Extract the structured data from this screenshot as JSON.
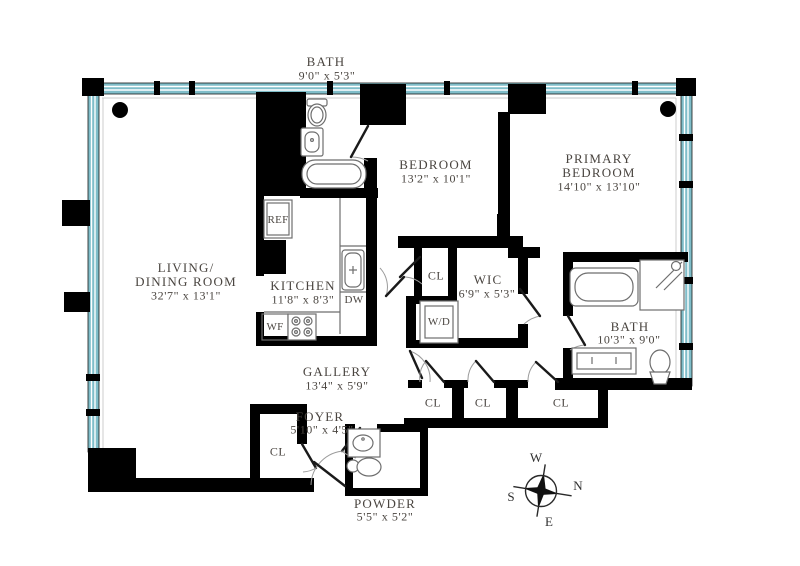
{
  "plan": {
    "rooms": {
      "bath_top": {
        "name": "BATH",
        "dims": "9'0\" x 5'3\""
      },
      "bedroom": {
        "name": "BEDROOM",
        "dims": "13'2\" x 10'1\""
      },
      "primary_bedroom": {
        "name_line1": "PRIMARY",
        "name_line2": "BEDROOM",
        "dims": "14'10\" x 13'10\""
      },
      "living_dining": {
        "name_line1": "LIVING/",
        "name_line2": "DINING ROOM",
        "dims": "32'7\" x 13'1\""
      },
      "kitchen": {
        "name": "KITCHEN",
        "dims": "11'8\" x 8'3\""
      },
      "wic": {
        "name": "WIC",
        "dims": "6'9\" x 5'3\""
      },
      "primary_bath": {
        "name": "BATH",
        "dims": "10'3\" x 9'0\""
      },
      "gallery": {
        "name": "GALLERY",
        "dims": "13'4\" x 5'9\""
      },
      "foyer": {
        "name": "FOYER",
        "dims": "5'10\" x 4'5\""
      },
      "powder": {
        "name": "POWDER",
        "dims": "5'5\" x 5'2\""
      }
    },
    "closets": {
      "hall": "CL",
      "row_1": "CL",
      "row_2": "CL",
      "row_3": "CL",
      "foyer": "CL"
    },
    "appliances": {
      "refrigerator": "REF",
      "dishwasher": "DW",
      "wine_fridge": "WF",
      "washer_dryer": "W/D"
    },
    "compass": {
      "north": "N",
      "south": "S",
      "east": "E",
      "west": "W"
    },
    "colors": {
      "wall": "#000000",
      "glass": "#7fbdc9",
      "label_text": "#4a4540",
      "fixture_line": "#6e6e6e"
    }
  }
}
